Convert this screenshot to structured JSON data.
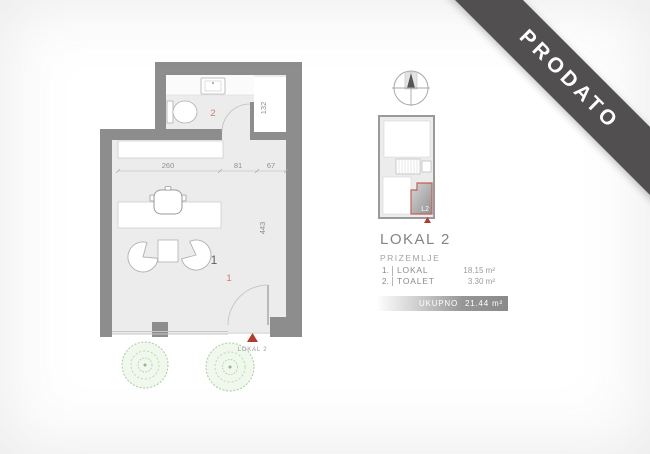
{
  "banner": {
    "label": "PRODATO"
  },
  "plan": {
    "dimensions": {
      "width_main": "260",
      "width_door": "81",
      "width_niche": "67",
      "height_niche": "132",
      "height_main": "443"
    },
    "rooms": {
      "room1_gray": "1",
      "room1_orange": "1",
      "room2_orange": "2"
    },
    "entry_marker": {
      "label": "LOKAL 2"
    }
  },
  "sitemap": {
    "unit_label": "L2"
  },
  "info": {
    "title": "LOKAL 2",
    "floor": "PRIZEMLJE",
    "rooms": [
      {
        "num": "1.",
        "name": "LOKAL",
        "area": "18.15 m²"
      },
      {
        "num": "2.",
        "name": "TOALET",
        "area": "3.30 m²"
      }
    ],
    "total_label": "UKUPNO",
    "total_area": "21.44 m²"
  },
  "colors": {
    "wall": "#8d8d8d",
    "floor": "#ececec",
    "accent_orange": "#c9826d",
    "accent_red": "#b23a2e",
    "banner_bg": "#514f50",
    "tree_green": "#a6cf9f"
  }
}
